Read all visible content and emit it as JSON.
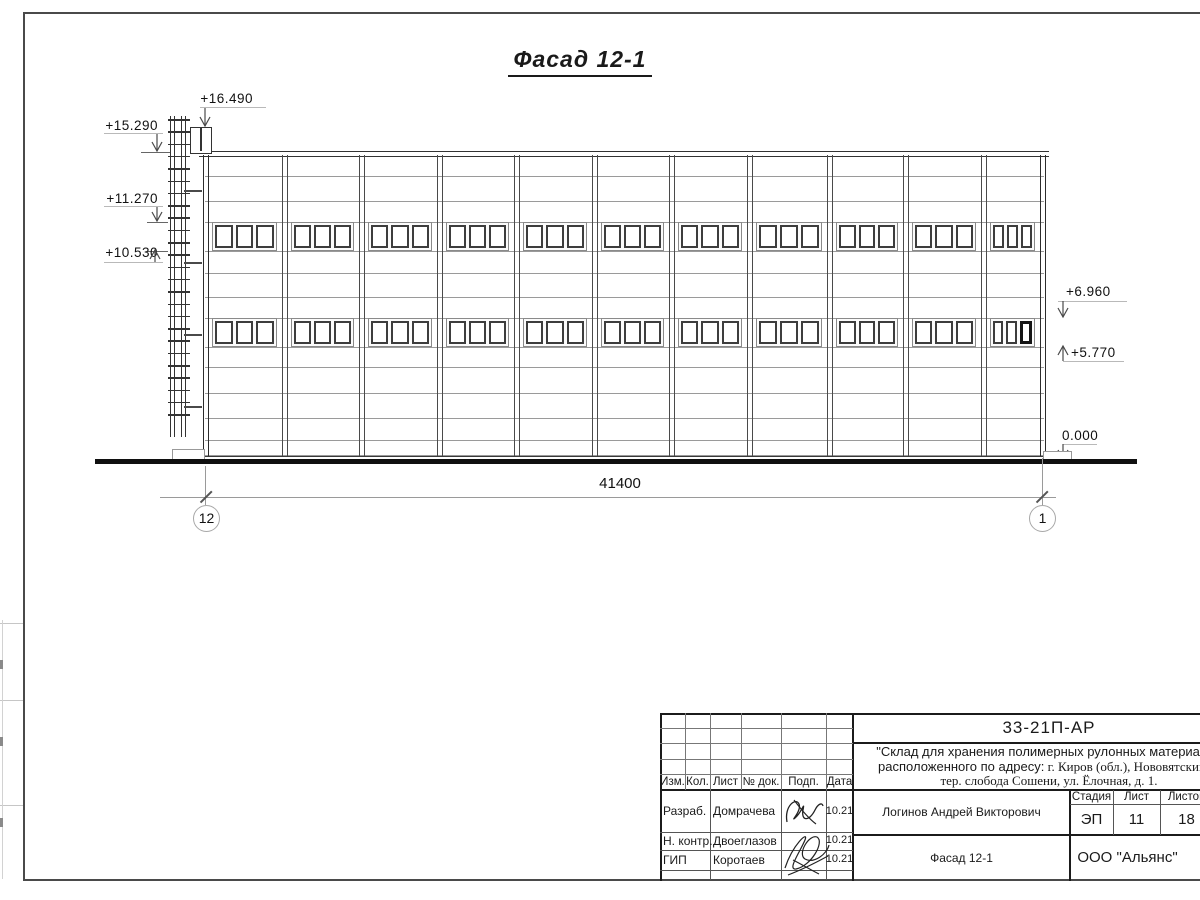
{
  "sheet": {
    "title": "Фасад 12-1"
  },
  "marks": {
    "left": [
      {
        "label": "+16.490"
      },
      {
        "label": "+15.290"
      },
      {
        "label": "+11.270"
      },
      {
        "label": "+10.530"
      }
    ],
    "right": [
      {
        "label": "+6.960"
      },
      {
        "label": "+5.770"
      },
      {
        "label": "0.000"
      }
    ]
  },
  "dimension": {
    "total": "41400"
  },
  "axes": {
    "left": "12",
    "right": "1"
  },
  "facade": {
    "bays": 11,
    "window_rows": 2,
    "panes_per_window": 3,
    "ladder_rungs": 25
  },
  "title_block": {
    "doc_number": "33-21П-АР",
    "project": {
      "line1": "\"Склад для хранения полимерных рулонных материалов",
      "line2_sans": "расположенного по адресу:",
      "line2_serif": " г. Киров (обл.), Нововятский р-",
      "line3": "тер. слобода Сошени, ул. Ёлочная, д. 1."
    },
    "cols": [
      "Изм.",
      "Кол.",
      "Лист",
      "№ док.",
      "Подп.",
      "Дата"
    ],
    "sig_rows": [
      {
        "role": "Разраб.",
        "name": "Домрачева",
        "date": "10.21"
      },
      {
        "role": "Н. контр.",
        "name": "Двоеглазов",
        "date": "10.21"
      },
      {
        "role": "ГИП",
        "name": "Коротаев",
        "date": "10.21"
      }
    ],
    "author_full": "Логинов Андрей Викторович",
    "stage_header": [
      "Стадия",
      "Лист",
      "Листов"
    ],
    "stage": "ЭП",
    "sheet_no": "11",
    "sheets_total": "18",
    "drawing_name": "Фасад 12-1",
    "company": "ООО \"Альянс\""
  }
}
